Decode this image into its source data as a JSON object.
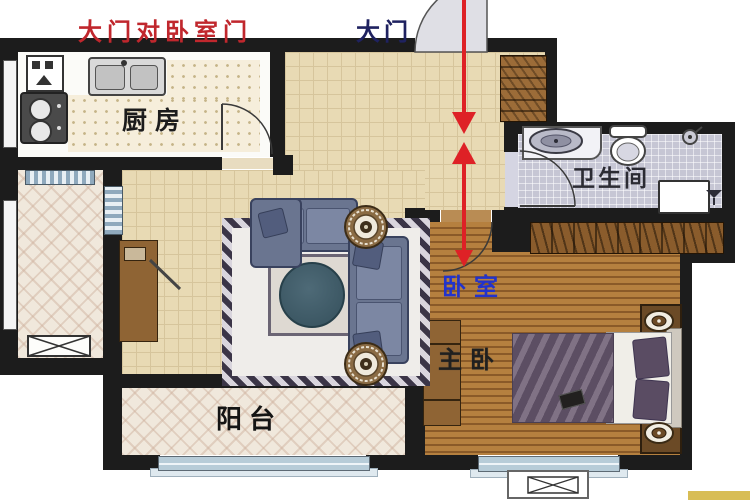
{
  "labels": {
    "warning": "大门对卧室门",
    "main_door": "大门",
    "kitchen": "厨房",
    "bathroom": "卫生间",
    "bedroom": "卧室",
    "master_bedroom": "主卧",
    "balcony": "阳台"
  },
  "colors": {
    "wall": "#1c1c1c",
    "warning_text": "#c0272d",
    "main_door_text": "#1f2260",
    "bedroom_text": "#2233cc",
    "clash_arrow": "#de2126",
    "living_floor": "#e8dab4",
    "bedroom_wood_floor": "#a06c33",
    "bathroom_floor": "#c6c6d4",
    "balcony_floor": "#f0e8dc",
    "kitchen_counter": "#f6eedb",
    "wood_furniture": "#8f6434",
    "sofa": "#6a7590",
    "bed_duvet": "#6e5e74",
    "window": "#b7ccd8",
    "rug_border": "#3b3547"
  }
}
